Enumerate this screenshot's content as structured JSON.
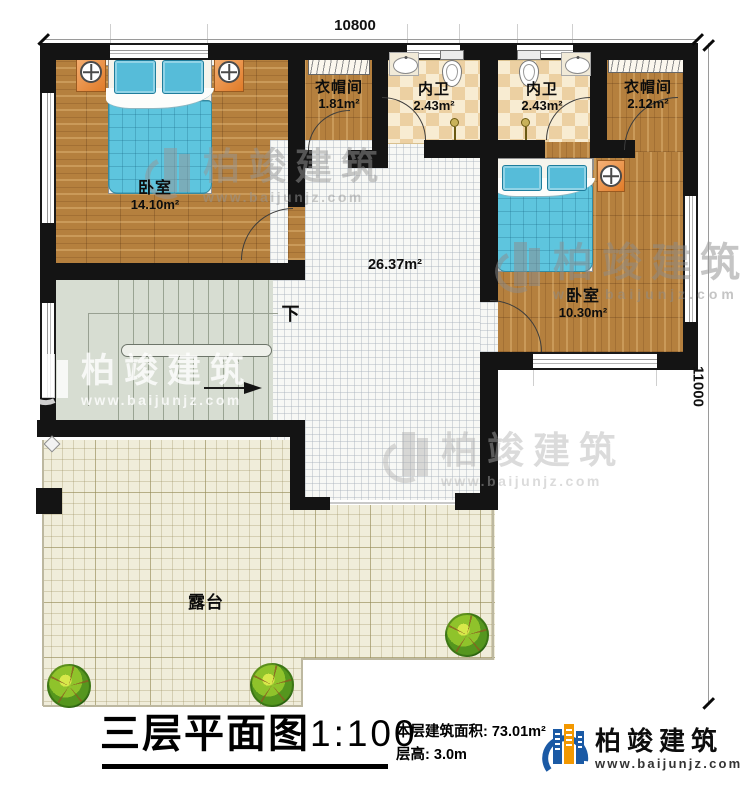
{
  "dimensions": {
    "top": "10800",
    "right": "11000"
  },
  "rooms": {
    "bedroom1": {
      "name": "卧室",
      "area": "14.10m²"
    },
    "cloakroom1": {
      "name": "衣帽间",
      "area": "1.81m²"
    },
    "bath1": {
      "name": "内卫",
      "area": "2.43m²"
    },
    "bath2": {
      "name": "内卫",
      "area": "2.43m²"
    },
    "cloakroom2": {
      "name": "衣帽间",
      "area": "2.12m²"
    },
    "bedroom2": {
      "name": "卧室",
      "area": "10.30m²"
    },
    "hall": {
      "area": "26.37m²"
    },
    "terrace": {
      "name": "露台"
    }
  },
  "stairs": {
    "direction_label": "下"
  },
  "watermark": {
    "brand": "柏竣建筑",
    "website": "www.baijunjz.com"
  },
  "title_block": {
    "plan_name": "三层平面图",
    "scale": "1:100",
    "area_label": "本层建筑面积:",
    "area_value": "73.01m²",
    "height_label": "层高:",
    "height_value": "3.0m"
  },
  "brand": {
    "name": "柏竣建筑",
    "website": "www.baijunjz.com",
    "blue": "#1b5aa5",
    "orange": "#f39800"
  }
}
